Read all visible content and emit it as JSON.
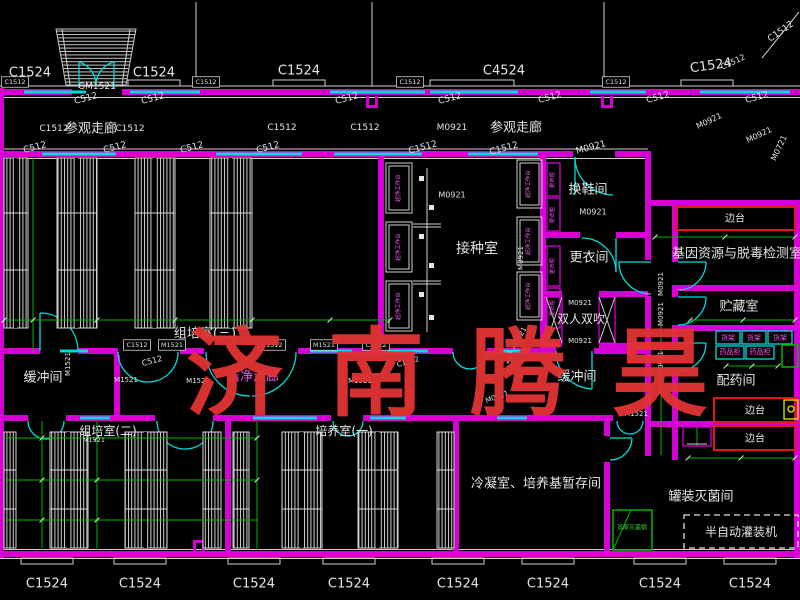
{
  "drawing": {
    "title": "实验室平面图",
    "watermark": {
      "text": "济南腾昊",
      "color": "#e23333"
    }
  },
  "colors": {
    "background": "#000000",
    "wall": "#d400d4",
    "window": "#00dcdc",
    "green": "#00b400",
    "red": "#e01818",
    "yellow": "#e8e800",
    "text_white": "#e4e4e4",
    "text_magenta": "#ee58ee",
    "text_green": "#35d435",
    "watermark": "#e23333"
  },
  "rooms": [
    "参观走廊",
    "组培室(三)",
    "接种室",
    "换鞋间",
    "更衣间",
    "双人双吹",
    "缓冲间",
    "洁净走廊",
    "组培室(二)",
    "培养室(一)",
    "冷凝室、培养基暂存间",
    "基因资源与脱毒检测室",
    "贮藏室",
    "配药间",
    "罐装灭菌间"
  ],
  "labels": [
    {
      "t": "C1524",
      "x": 30,
      "y": 73,
      "s": 13
    },
    {
      "t": "C1524",
      "x": 154,
      "y": 73,
      "s": 13
    },
    {
      "t": "C1524",
      "x": 299,
      "y": 71,
      "s": 13
    },
    {
      "t": "C4524",
      "x": 504,
      "y": 71,
      "s": 13
    },
    {
      "t": "C1524",
      "x": 711,
      "y": 66,
      "s": 13,
      "r": -8
    },
    {
      "t": "C1512",
      "x": 781,
      "y": 32,
      "s": 9,
      "r": -35
    },
    {
      "t": "C1512",
      "x": 733,
      "y": 62,
      "s": 8,
      "r": -25
    },
    {
      "t": "M0921",
      "x": 709,
      "y": 121,
      "s": 8,
      "r": -25
    },
    {
      "t": "M0921",
      "x": 759,
      "y": 135,
      "s": 8,
      "r": -25
    },
    {
      "t": "M0721",
      "x": 779,
      "y": 148,
      "s": 8,
      "r": -65
    },
    {
      "t": "C1512",
      "x": 15,
      "y": 82,
      "s": 6.5,
      "b": 1
    },
    {
      "t": "C1512",
      "x": 206,
      "y": 82,
      "s": 6.5,
      "b": 1
    },
    {
      "t": "C1512",
      "x": 410,
      "y": 82,
      "s": 6.5,
      "b": 1
    },
    {
      "t": "C1512",
      "x": 616,
      "y": 82,
      "s": 6.5,
      "b": 1
    },
    {
      "t": "C512",
      "x": 86,
      "y": 99,
      "s": 9,
      "r": -15
    },
    {
      "t": "C512",
      "x": 153,
      "y": 99,
      "s": 9,
      "r": -15
    },
    {
      "t": "C512",
      "x": 347,
      "y": 99,
      "s": 9,
      "r": -15
    },
    {
      "t": "C512",
      "x": 450,
      "y": 99,
      "s": 9,
      "r": -15
    },
    {
      "t": "C512",
      "x": 550,
      "y": 98,
      "s": 9,
      "r": -15
    },
    {
      "t": "C512",
      "x": 658,
      "y": 98,
      "s": 9,
      "r": -15
    },
    {
      "t": "C512",
      "x": 757,
      "y": 98,
      "s": 9,
      "r": -15
    },
    {
      "t": "GM1521",
      "x": 97,
      "y": 87,
      "s": 9
    },
    {
      "t": "C1512",
      "x": 54,
      "y": 129,
      "s": 9
    },
    {
      "t": "参观走廊",
      "x": 91,
      "y": 129,
      "s": 13
    },
    {
      "t": "C1512",
      "x": 130,
      "y": 129,
      "s": 9
    },
    {
      "t": "C1512",
      "x": 282,
      "y": 128,
      "s": 9
    },
    {
      "t": "C1512",
      "x": 365,
      "y": 128,
      "s": 9
    },
    {
      "t": "M0921",
      "x": 452,
      "y": 128,
      "s": 9
    },
    {
      "t": "参观走廊",
      "x": 516,
      "y": 128,
      "s": 13
    },
    {
      "t": "C512",
      "x": 35,
      "y": 148,
      "s": 9,
      "r": -15
    },
    {
      "t": "C512",
      "x": 115,
      "y": 148,
      "s": 9,
      "r": -15
    },
    {
      "t": "C512",
      "x": 192,
      "y": 148,
      "s": 9,
      "r": -15
    },
    {
      "t": "C512",
      "x": 268,
      "y": 148,
      "s": 9,
      "r": -15
    },
    {
      "t": "C1512",
      "x": 423,
      "y": 148,
      "s": 9,
      "r": -15
    },
    {
      "t": "C1512",
      "x": 504,
      "y": 149,
      "s": 9,
      "r": -15
    },
    {
      "t": "M0921",
      "x": 591,
      "y": 148,
      "s": 9,
      "r": -15
    },
    {
      "t": "M0921",
      "x": 452,
      "y": 195,
      "s": 8
    },
    {
      "t": "接种室",
      "x": 477,
      "y": 249,
      "s": 14
    },
    {
      "t": "换鞋间",
      "x": 588,
      "y": 190,
      "s": 13
    },
    {
      "t": "M0921",
      "x": 593,
      "y": 212,
      "s": 8
    },
    {
      "t": "更衣间",
      "x": 589,
      "y": 258,
      "s": 13
    },
    {
      "t": "M0921",
      "x": 580,
      "y": 303,
      "s": 7
    },
    {
      "t": "双人双吹",
      "x": 581,
      "y": 319,
      "s": 12
    },
    {
      "t": "M0921",
      "x": 580,
      "y": 341,
      "s": 7
    },
    {
      "t": "缓冲间",
      "x": 577,
      "y": 377,
      "s": 13
    },
    {
      "t": "M1521",
      "x": 636,
      "y": 414,
      "s": 7
    },
    {
      "t": "M0921",
      "x": 661,
      "y": 284,
      "s": 7,
      "r": -90
    },
    {
      "t": "M0921",
      "x": 661,
      "y": 314,
      "s": 7,
      "r": -90
    },
    {
      "t": "M0921",
      "x": 661,
      "y": 363,
      "s": 7,
      "r": -90
    },
    {
      "t": "M0921",
      "x": 497,
      "y": 397,
      "s": 7,
      "r": -20
    },
    {
      "t": "C1512",
      "x": 510,
      "y": 362,
      "s": 7,
      "r": -90
    },
    {
      "t": "M0921",
      "x": 519,
      "y": 338,
      "s": 7,
      "r": -60
    },
    {
      "t": "M0921",
      "x": 521,
      "y": 258,
      "s": 7,
      "r": -90
    },
    {
      "t": "组培室(三)",
      "x": 205,
      "y": 334,
      "s": 13
    },
    {
      "t": "C1512",
      "x": 137,
      "y": 345,
      "s": 6.5,
      "b": 1
    },
    {
      "t": "M1521",
      "x": 172,
      "y": 345,
      "s": 6.5,
      "b": 1
    },
    {
      "t": "C1512",
      "x": 272,
      "y": 345,
      "s": 6.5,
      "b": 1
    },
    {
      "t": "M1521",
      "x": 324,
      "y": 345,
      "s": 6.5,
      "b": 1
    },
    {
      "t": "C1512",
      "x": 376,
      "y": 345,
      "s": 6.5,
      "b": 1
    },
    {
      "t": "C512",
      "x": 152,
      "y": 361,
      "s": 8,
      "r": -15
    },
    {
      "t": "洁净走廊",
      "x": 253,
      "y": 377,
      "s": 13,
      "c": "m"
    },
    {
      "t": "M1521",
      "x": 198,
      "y": 381,
      "s": 7
    },
    {
      "t": "M1521",
      "x": 360,
      "y": 381,
      "s": 7
    },
    {
      "t": "M1521",
      "x": 68,
      "y": 364,
      "s": 7,
      "r": -90
    },
    {
      "t": "缓冲间",
      "x": 43,
      "y": 378,
      "s": 13
    },
    {
      "t": "M1521",
      "x": 126,
      "y": 380,
      "s": 7
    },
    {
      "t": "C1512",
      "x": 408,
      "y": 362,
      "s": 7,
      "r": -15
    },
    {
      "t": "C512",
      "x": 410,
      "y": 398,
      "s": 7,
      "r": -90
    },
    {
      "t": "组培室(二)",
      "x": 108,
      "y": 431,
      "s": 12
    },
    {
      "t": "M1521",
      "x": 94,
      "y": 440,
      "s": 6.5
    },
    {
      "t": "培养室(一)",
      "x": 344,
      "y": 431,
      "s": 12
    },
    {
      "t": "冷凝室、培养基暂存间",
      "x": 536,
      "y": 484,
      "s": 13
    },
    {
      "t": "基因资源与脱毒检测室",
      "x": 737,
      "y": 254,
      "s": 13
    },
    {
      "t": "边台",
      "x": 735,
      "y": 219,
      "s": 10
    },
    {
      "t": "边台",
      "x": 755,
      "y": 411,
      "s": 10
    },
    {
      "t": "边台",
      "x": 755,
      "y": 439,
      "s": 10
    },
    {
      "t": "贮藏室",
      "x": 739,
      "y": 307,
      "s": 13
    },
    {
      "t": "货架",
      "x": 728,
      "y": 338,
      "s": 7,
      "c": "m"
    },
    {
      "t": "货架",
      "x": 754,
      "y": 338,
      "s": 7,
      "c": "m"
    },
    {
      "t": "货架",
      "x": 780,
      "y": 338,
      "s": 7,
      "c": "m"
    },
    {
      "t": "药品柜",
      "x": 730,
      "y": 352,
      "s": 7,
      "c": "m"
    },
    {
      "t": "药品柜",
      "x": 760,
      "y": 352,
      "s": 7,
      "c": "m"
    },
    {
      "t": "配药间",
      "x": 736,
      "y": 381,
      "s": 13
    },
    {
      "t": "罐装灭菌间",
      "x": 701,
      "y": 497,
      "s": 13
    },
    {
      "t": "双扉灭菌锅",
      "x": 632,
      "y": 528,
      "s": 6,
      "c": "g"
    },
    {
      "t": "半自动灌装机",
      "x": 741,
      "y": 532,
      "s": 12
    },
    {
      "t": "C1524",
      "x": 47,
      "y": 584,
      "s": 13
    },
    {
      "t": "C1524",
      "x": 140,
      "y": 584,
      "s": 13
    },
    {
      "t": "C1524",
      "x": 254,
      "y": 584,
      "s": 13
    },
    {
      "t": "C1524",
      "x": 349,
      "y": 584,
      "s": 13
    },
    {
      "t": "C1524",
      "x": 458,
      "y": 584,
      "s": 13
    },
    {
      "t": "C1524",
      "x": 548,
      "y": 584,
      "s": 13
    },
    {
      "t": "C1524",
      "x": 660,
      "y": 584,
      "s": 13
    },
    {
      "t": "C1524",
      "x": 750,
      "y": 584,
      "s": 13
    },
    {
      "t": "超净工作台",
      "x": 399,
      "y": 188,
      "s": 5.5,
      "c": "m",
      "r": -90
    },
    {
      "t": "超净工作台",
      "x": 399,
      "y": 247,
      "s": 5.5,
      "c": "m",
      "r": -90
    },
    {
      "t": "超净工作台",
      "x": 399,
      "y": 306,
      "s": 5.5,
      "c": "m",
      "r": -90
    },
    {
      "t": "超净工作台",
      "x": 529,
      "y": 184,
      "s": 5.5,
      "c": "m",
      "r": -90
    },
    {
      "t": "超净工作台",
      "x": 529,
      "y": 241,
      "s": 5.5,
      "c": "m",
      "r": -90
    },
    {
      "t": "超净工作台",
      "x": 529,
      "y": 296,
      "s": 5.5,
      "c": "m",
      "r": -90
    },
    {
      "t": "更衣柜",
      "x": 553,
      "y": 180,
      "s": 5.5,
      "c": "m",
      "r": -90
    },
    {
      "t": "更衣柜",
      "x": 553,
      "y": 215,
      "s": 5.5,
      "c": "m",
      "r": -90
    },
    {
      "t": "更衣柜",
      "x": 553,
      "y": 266,
      "s": 5.5,
      "c": "m",
      "r": -90
    },
    {
      "t": "更衣柜",
      "x": 553,
      "y": 308,
      "s": 5.5,
      "c": "m",
      "r": -90
    }
  ]
}
